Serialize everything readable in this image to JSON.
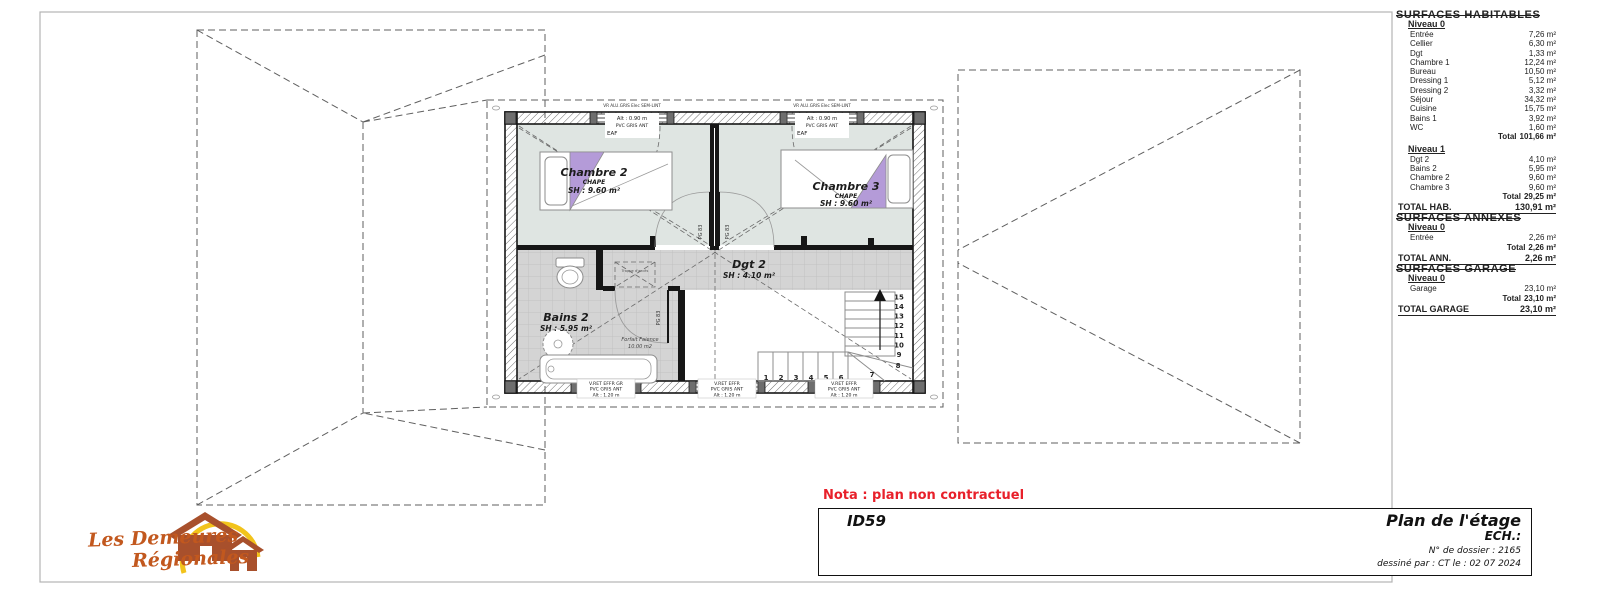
{
  "colors": {
    "nota_red": "#e8202a",
    "logo_text": "#c2581e",
    "logo_house": "#a8502c",
    "logo_arc": "#f2c31b",
    "bedroom_fill": "#dfe5e2",
    "tile_fill": "#d4d4d4",
    "purple": "#b49bd8"
  },
  "nota": {
    "text": "Nota : plan non contractuel"
  },
  "title_block": {
    "id": "ID59",
    "title": "Plan de l'étage",
    "scale": "ECH.:",
    "dossier": "N° de dossier : 2165",
    "drawn": "dessiné par : CT   le : 02 07 2024"
  },
  "logo": {
    "line1": "Les Demeures",
    "line2": "Régionales"
  },
  "surfaces": {
    "sections": [
      {
        "title": "SURFACES HABITABLES",
        "blocks": [
          {
            "level": "Niveau 0",
            "rows": [
              [
                "Entrée",
                "7,26 m²"
              ],
              [
                "Cellier",
                "6,30 m²"
              ],
              [
                "Dgt",
                "1,33 m²"
              ],
              [
                "Chambre 1",
                "12,24 m²"
              ],
              [
                "Bureau",
                "10,50 m²"
              ],
              [
                "Dressing 1",
                "5,12 m²"
              ],
              [
                "Dressing 2",
                "3,32 m²"
              ],
              [
                "Séjour",
                "34,32 m²"
              ],
              [
                "Cuisine",
                "15,75 m²"
              ],
              [
                "Bains 1",
                "3,92 m²"
              ],
              [
                "WC",
                "1,60 m²"
              ]
            ],
            "total": [
              "Total",
              "101,66 m²"
            ]
          },
          {
            "level": "Niveau 1",
            "rows": [
              [
                "Dgt 2",
                "4,10 m²"
              ],
              [
                "Bains 2",
                "5,95 m²"
              ],
              [
                "Chambre 2",
                "9,60 m²"
              ],
              [
                "Chambre 3",
                "9,60 m²"
              ]
            ],
            "total": [
              "Total",
              "29,25 m²"
            ]
          }
        ],
        "grand": [
          "TOTAL HAB.",
          "130,91 m²"
        ]
      },
      {
        "title": "SURFACES ANNEXES",
        "blocks": [
          {
            "level": "Niveau 0",
            "rows": [
              [
                "Entrée",
                "2,26 m²"
              ]
            ],
            "total": [
              "Total",
              "2,26 m²"
            ]
          }
        ],
        "grand": [
          "TOTAL ANN.",
          "2,26 m²"
        ]
      },
      {
        "title": "SURFACES GARAGE",
        "blocks": [
          {
            "level": "Niveau 0",
            "rows": [
              [
                "Garage",
                "23,10 m²"
              ]
            ],
            "total": [
              "Total",
              "23,10 m²"
            ]
          }
        ],
        "grand": [
          "TOTAL GARAGE",
          "23,10 m²"
        ]
      }
    ]
  },
  "plan": {
    "rooms": [
      {
        "name": "Chambre 2",
        "sub": "CHAPE",
        "area": "SH : 9.60 m²"
      },
      {
        "name": "Chambre 3",
        "sub": "CHAPE",
        "area": "SH : 9.60 m²"
      },
      {
        "name": "Dgt 2",
        "area": "SH : 4.10 m²"
      },
      {
        "name": "Bains 2",
        "area": "SH : 5.95 m²"
      }
    ],
    "windows_top": [
      {
        "head": "VR ALU.GRIS Elec SEM-LINT",
        "l1": "Alt : 0.90 m",
        "l2": "PVC GRIS ANT",
        "l3": "EAF"
      },
      {
        "head": "VR ALU.GRIS Elec SEM-LINT",
        "l1": "Alt : 0.90 m",
        "l2": "PVC GRIS ANT",
        "l3": "EAF"
      }
    ],
    "windows_bottom": [
      {
        "l1": "V.RET EFFR GR",
        "l2": "PVC GRIS ANT",
        "l3": "Alt : 1.20 m"
      },
      {
        "l1": "V.RET EFFR",
        "l2": "PVC GRIS ANT",
        "l3": "Alt : 1.20 m"
      },
      {
        "l1": "V.RET EFFR",
        "l2": "PVC GRIS ANT",
        "l3": "Alt : 1.20 m"
      }
    ],
    "door_label": "PG 83",
    "trappe_label": "Trappe d'accès",
    "faience_note": [
      "Forfait Faience",
      "10.00 m2"
    ],
    "stairs": {
      "steps": [
        "1",
        "2",
        "3",
        "4",
        "5",
        "6",
        "7",
        "8",
        "9",
        "10",
        "11",
        "12",
        "13",
        "14",
        "15"
      ]
    }
  }
}
